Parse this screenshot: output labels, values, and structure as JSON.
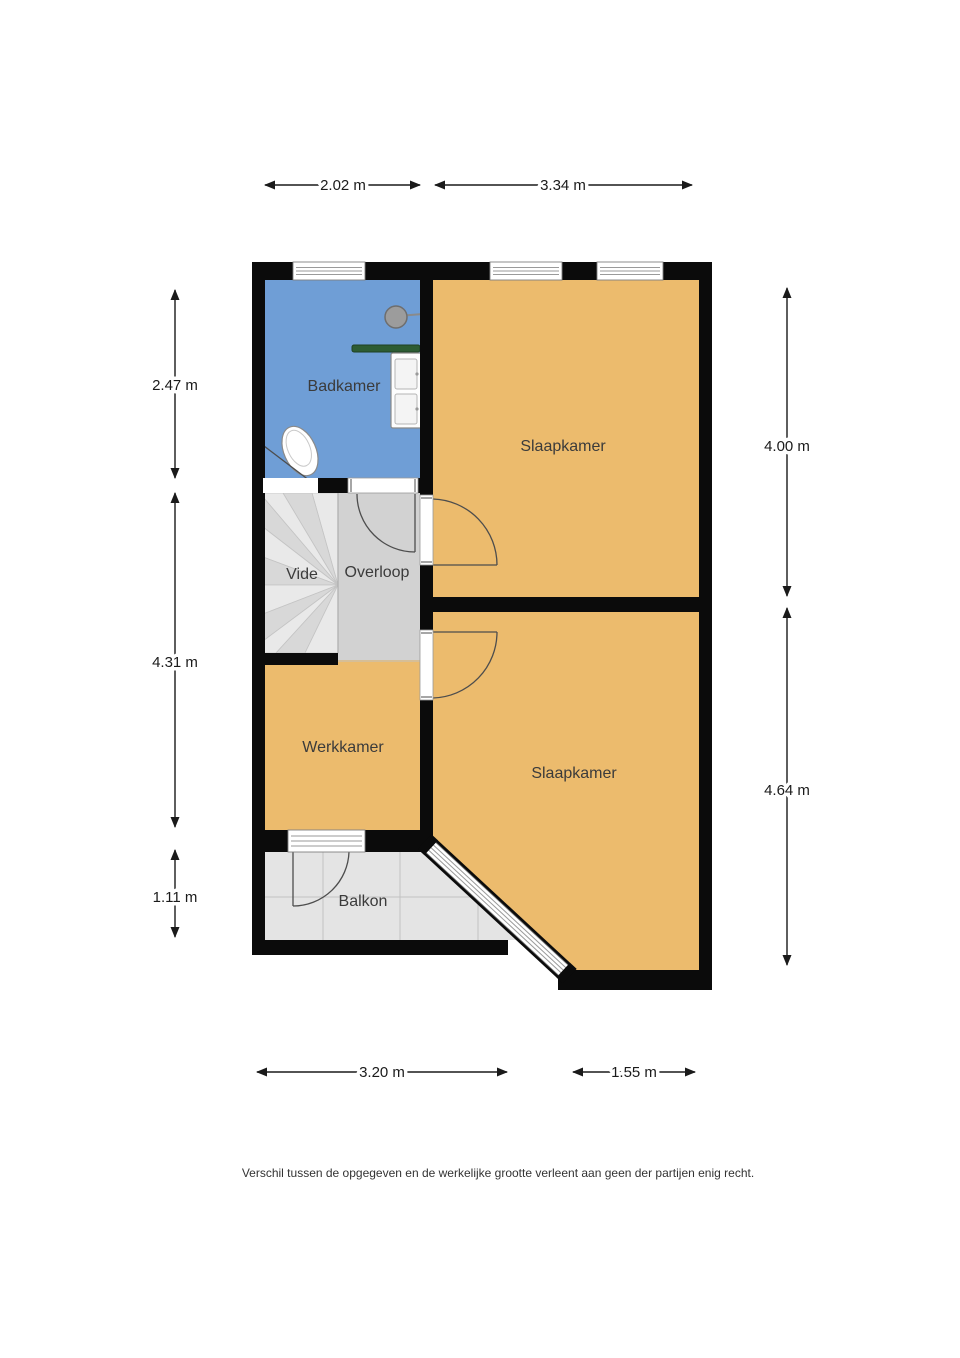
{
  "floorplan": {
    "rooms": {
      "badkamer": {
        "label": "Badkamer"
      },
      "slaapkamer_boven": {
        "label": "Slaapkamer"
      },
      "vide": {
        "label": "Vide"
      },
      "overloop": {
        "label": "Overloop"
      },
      "werkkamer": {
        "label": "Werkkamer"
      },
      "slaapkamer_onder": {
        "label": "Slaapkamer"
      },
      "balkon": {
        "label": "Balkon"
      }
    },
    "dimensions": {
      "top": [
        {
          "label": "2.02 m"
        },
        {
          "label": "3.34 m"
        }
      ],
      "left": [
        {
          "label": "2.47 m"
        },
        {
          "label": "4.31 m"
        },
        {
          "label": "1.11 m"
        }
      ],
      "right": [
        {
          "label": "4.00 m"
        },
        {
          "label": "4.64 m"
        }
      ],
      "bottom": [
        {
          "label": "3.20 m"
        },
        {
          "label": "1.55 m"
        }
      ]
    },
    "icons": {
      "shower": "shower-head-icon",
      "towel_rail": "towel-rail-icon",
      "washbasin": "double-washbasin-icon",
      "toilet": "toilet-icon",
      "stairs": "winder-stairs-icon"
    },
    "colors": {
      "wall": "#0b0b0b",
      "room": "#ecbb6d",
      "bathroom": "#6f9ed6",
      "landing": "#d2d2d2",
      "stairs": "#dcdcdc",
      "balcony": "#e4e4e4",
      "towel_rail": "#2d5c33",
      "label_text": "#3b3b3b",
      "dimension_text": "#1b1b1b"
    }
  },
  "footer": {
    "disclaimer": "Verschil tussen de opgegeven en de werkelijke grootte verleent aan geen der partijen enig recht."
  }
}
